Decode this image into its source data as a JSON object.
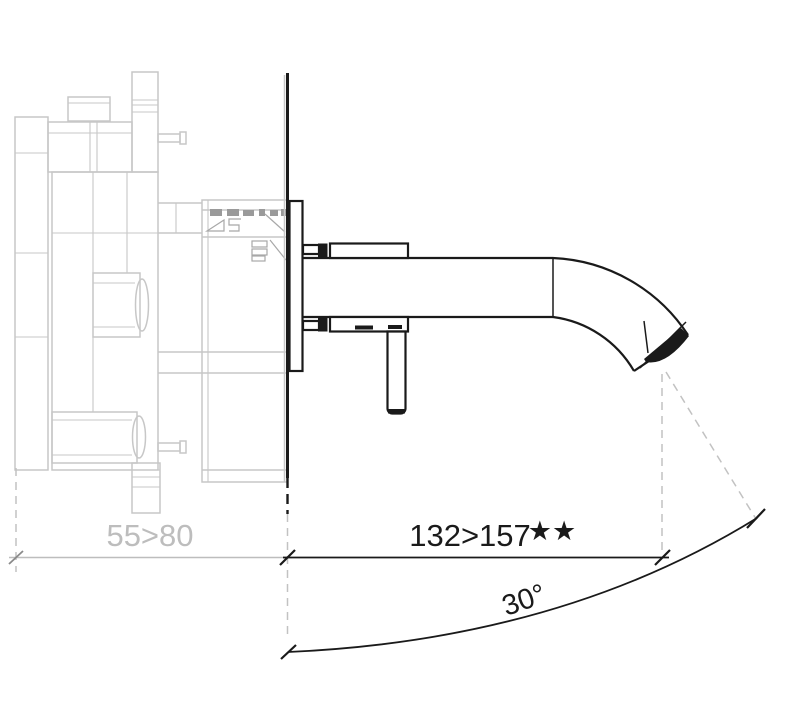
{
  "drawing": {
    "kind": "faucet-installation-technical-drawing",
    "dimensions": {
      "rough_in_depth": "55>80",
      "spout_projection": "132>157",
      "spout_projection_marker": "★★",
      "spray_angle": "30°"
    },
    "colors": {
      "foreground": "#1a1a1a",
      "concealed_lines": "#c7c7c7",
      "concealed_marks": "#9a9a9a",
      "dimension_gray": "#bdbdbd",
      "dashed_gray": "#c2c2c2",
      "background": "#ffffff"
    }
  }
}
